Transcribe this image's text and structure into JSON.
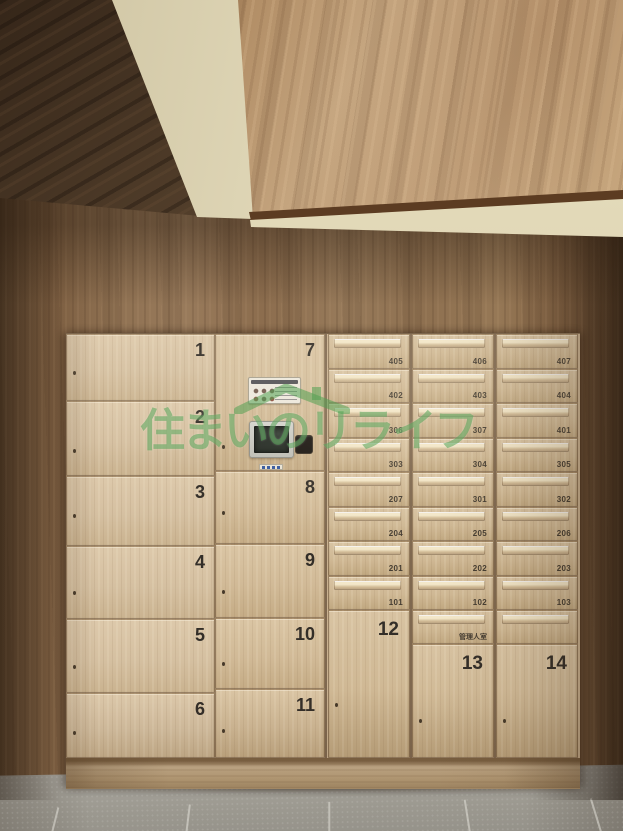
{
  "watermark": {
    "text": "住まいのリライフ",
    "icon": "house-roof-icon",
    "color": "#52a052"
  },
  "delivery_lockers": {
    "column_left": [
      "1",
      "2",
      "3",
      "4",
      "5",
      "6"
    ],
    "column_middle": [
      "7",
      "8",
      "9",
      "10",
      "11"
    ],
    "column_bottom": [
      "12",
      "13",
      "14"
    ]
  },
  "mailboxes": {
    "column_a": [
      "405",
      "402",
      "306",
      "303",
      "207",
      "204",
      "201",
      "101"
    ],
    "column_b": [
      "406",
      "403",
      "307",
      "304",
      "301",
      "205",
      "202",
      "102",
      "管理人室"
    ],
    "column_c": [
      "407",
      "404",
      "401",
      "305",
      "302",
      "206",
      "203",
      "103",
      ""
    ]
  },
  "control_panel": {
    "screen_icon": "touchscreen-display",
    "card_reader_icon": "ic-card-reader",
    "sticker_icon": "usage-instructions-sticker",
    "buttons_icon": "blue-button-strip"
  },
  "colors": {
    "wall_wood": "#8f7154",
    "ceiling_wood": "#b08a68",
    "dark_ceiling_wood": "#4a3829",
    "cream_beam": "#d9d0b0",
    "locker_wood": "#d4bf9f",
    "floor_tile": "#9d9a92",
    "number_text": "#332e28",
    "watermark_green": "#52a052"
  }
}
